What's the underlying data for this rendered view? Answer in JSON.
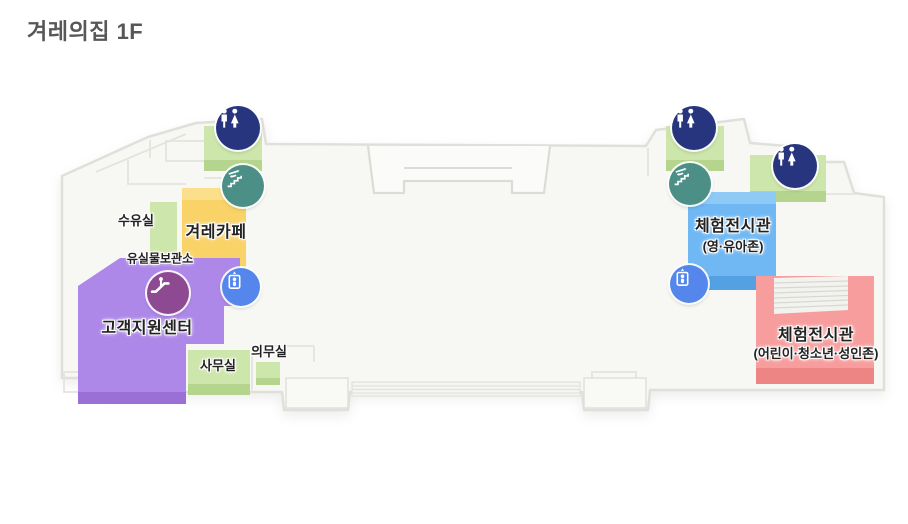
{
  "title": "겨레의집 1F",
  "map": {
    "labels": {
      "nursing_room": "수유실",
      "cafe": "겨레카페",
      "lost_and_found": "유실물보관소",
      "customer_support_center": "고객지원센터",
      "office": "사무실",
      "medical_room": "의무실",
      "exhibition_infant": {
        "line1": "체험전시관",
        "line2": "(영·유아존)"
      },
      "exhibition_children": {
        "line1": "체험전시관",
        "line2": "(어린이·청소년·성인존)"
      }
    },
    "icons": {
      "restroom": "restroom-icon",
      "stairs": "stairs-icon",
      "escalator": "escalator-icon",
      "elevator": "elevator-icon"
    },
    "colors": {
      "room_green": "#cde6ab",
      "room_yellow": "#f9d368",
      "room_purple": "#ae88e9",
      "room_blue": "#6fb8f4",
      "room_red": "#f89d9d",
      "icon_navy": "#26357d",
      "icon_teal": "#4b8f87",
      "icon_plum": "#8d4a92",
      "icon_blue": "#5486ec",
      "title_gray": "#575757"
    }
  }
}
